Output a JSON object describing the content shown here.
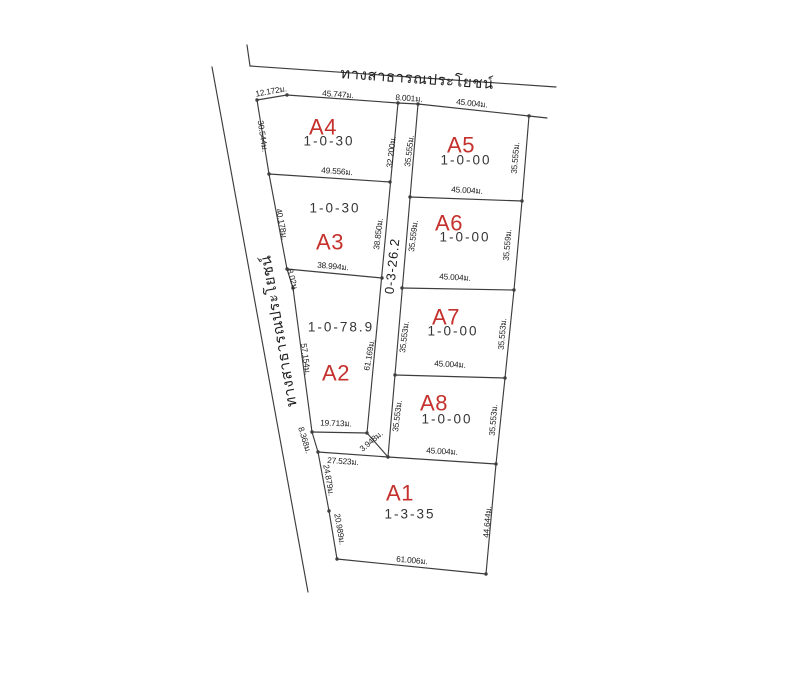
{
  "colors": {
    "background": "#ffffff",
    "line": "#3d3d3d",
    "plot_id_red": "#c5312c",
    "text": "#1e1e1e"
  },
  "roads": {
    "top": {
      "label": "ทางสาธารณประโยชน์",
      "pos": [
        417,
        79
      ],
      "rot": 4
    },
    "left": {
      "label": "ทางสาธารณประโยชน์",
      "pos": [
        279,
        331
      ],
      "rot": -100
    },
    "internal_strip": {
      "area_code": "0-3-26.2",
      "pos": [
        392,
        266
      ],
      "rot": -84
    }
  },
  "plots": [
    {
      "id": "A4",
      "area_code": "1-0-30",
      "id_pos": [
        323,
        127
      ],
      "area_pos": [
        329,
        141
      ]
    },
    {
      "id": "A5",
      "area_code": "1-0-00",
      "id_pos": [
        461,
        145
      ],
      "area_pos": [
        466,
        160
      ]
    },
    {
      "id": "A3",
      "area_code": "1-0-30",
      "id_pos": [
        330,
        242
      ],
      "area_pos": [
        335,
        208
      ]
    },
    {
      "id": "A6",
      "area_code": "1-0-00",
      "id_pos": [
        449,
        223
      ],
      "area_pos": [
        465,
        237
      ]
    },
    {
      "id": "A2",
      "area_code": "1-0-78.9",
      "id_pos": [
        336,
        373
      ],
      "area_pos": [
        341,
        327
      ]
    },
    {
      "id": "A7",
      "area_code": "1-0-00",
      "id_pos": [
        446,
        317
      ],
      "area_pos": [
        453,
        331
      ]
    },
    {
      "id": "A8",
      "area_code": "1-0-00",
      "id_pos": [
        434,
        403
      ],
      "area_pos": [
        447,
        419
      ]
    },
    {
      "id": "A1",
      "area_code": "1-3-35",
      "id_pos": [
        400,
        493
      ],
      "area_pos": [
        410,
        514
      ]
    }
  ],
  "dimensions": [
    {
      "text": "12.172ม.",
      "x": 271,
      "y": 91,
      "rot": -10
    },
    {
      "text": "45.747ม.",
      "x": 338,
      "y": 94,
      "rot": 4
    },
    {
      "text": "8.001ม.",
      "x": 409,
      "y": 98,
      "rot": 4
    },
    {
      "text": "45.004ม.",
      "x": 472,
      "y": 103,
      "rot": 6
    },
    {
      "text": "30.544ม.",
      "x": 263,
      "y": 136,
      "rot": 81
    },
    {
      "text": "49.556ม.",
      "x": 337,
      "y": 171,
      "rot": 4
    },
    {
      "text": "40.178ม.",
      "x": 282,
      "y": 224,
      "rot": 79
    },
    {
      "text": "38.994ม.",
      "x": 333,
      "y": 266,
      "rot": 5
    },
    {
      "text": "8.02ม.",
      "x": 293,
      "y": 280,
      "rot": 75
    },
    {
      "text": "57.154ม.",
      "x": 306,
      "y": 359,
      "rot": 82
    },
    {
      "text": "19.713ม.",
      "x": 336,
      "y": 423,
      "rot": 2
    },
    {
      "text": "3.948ม.",
      "x": 371,
      "y": 441,
      "rot": -40
    },
    {
      "text": "8.368ม.",
      "x": 305,
      "y": 440,
      "rot": 73
    },
    {
      "text": "27.523ม.",
      "x": 343,
      "y": 461,
      "rot": 4
    },
    {
      "text": "24.879ม.",
      "x": 329,
      "y": 480,
      "rot": 80
    },
    {
      "text": "20.989ม.",
      "x": 340,
      "y": 529,
      "rot": 80
    },
    {
      "text": "61.006ม.",
      "x": 412,
      "y": 560,
      "rot": 5
    },
    {
      "text": "44.644ม.",
      "x": 487,
      "y": 522,
      "rot": -85
    },
    {
      "text": "32.200ม.",
      "x": 391,
      "y": 152,
      "rot": -83
    },
    {
      "text": "35.555ม.",
      "x": 409,
      "y": 151,
      "rot": -83
    },
    {
      "text": "38.850ม.",
      "x": 378,
      "y": 234,
      "rot": -83
    },
    {
      "text": "35.559ม.",
      "x": 413,
      "y": 236,
      "rot": -83
    },
    {
      "text": "61.169ม.",
      "x": 369,
      "y": 355,
      "rot": -80
    },
    {
      "text": "35.553ม.",
      "x": 404,
      "y": 337,
      "rot": -83
    },
    {
      "text": "35.553ม.",
      "x": 397,
      "y": 416,
      "rot": -83
    },
    {
      "text": "45.004ม.",
      "x": 467,
      "y": 190,
      "rot": 3
    },
    {
      "text": "45.004ม.",
      "x": 455,
      "y": 277,
      "rot": 3
    },
    {
      "text": "45.004ม.",
      "x": 450,
      "y": 364,
      "rot": 3
    },
    {
      "text": "45.004ม.",
      "x": 442,
      "y": 451,
      "rot": 3
    },
    {
      "text": "35.555ม.",
      "x": 515,
      "y": 158,
      "rot": -85
    },
    {
      "text": "35.559ม.",
      "x": 507,
      "y": 245,
      "rot": -85
    },
    {
      "text": "35.553ม.",
      "x": 502,
      "y": 334,
      "rot": -85
    },
    {
      "text": "35.553ม.",
      "x": 493,
      "y": 420,
      "rot": -85
    }
  ],
  "geometry_note": ""
}
